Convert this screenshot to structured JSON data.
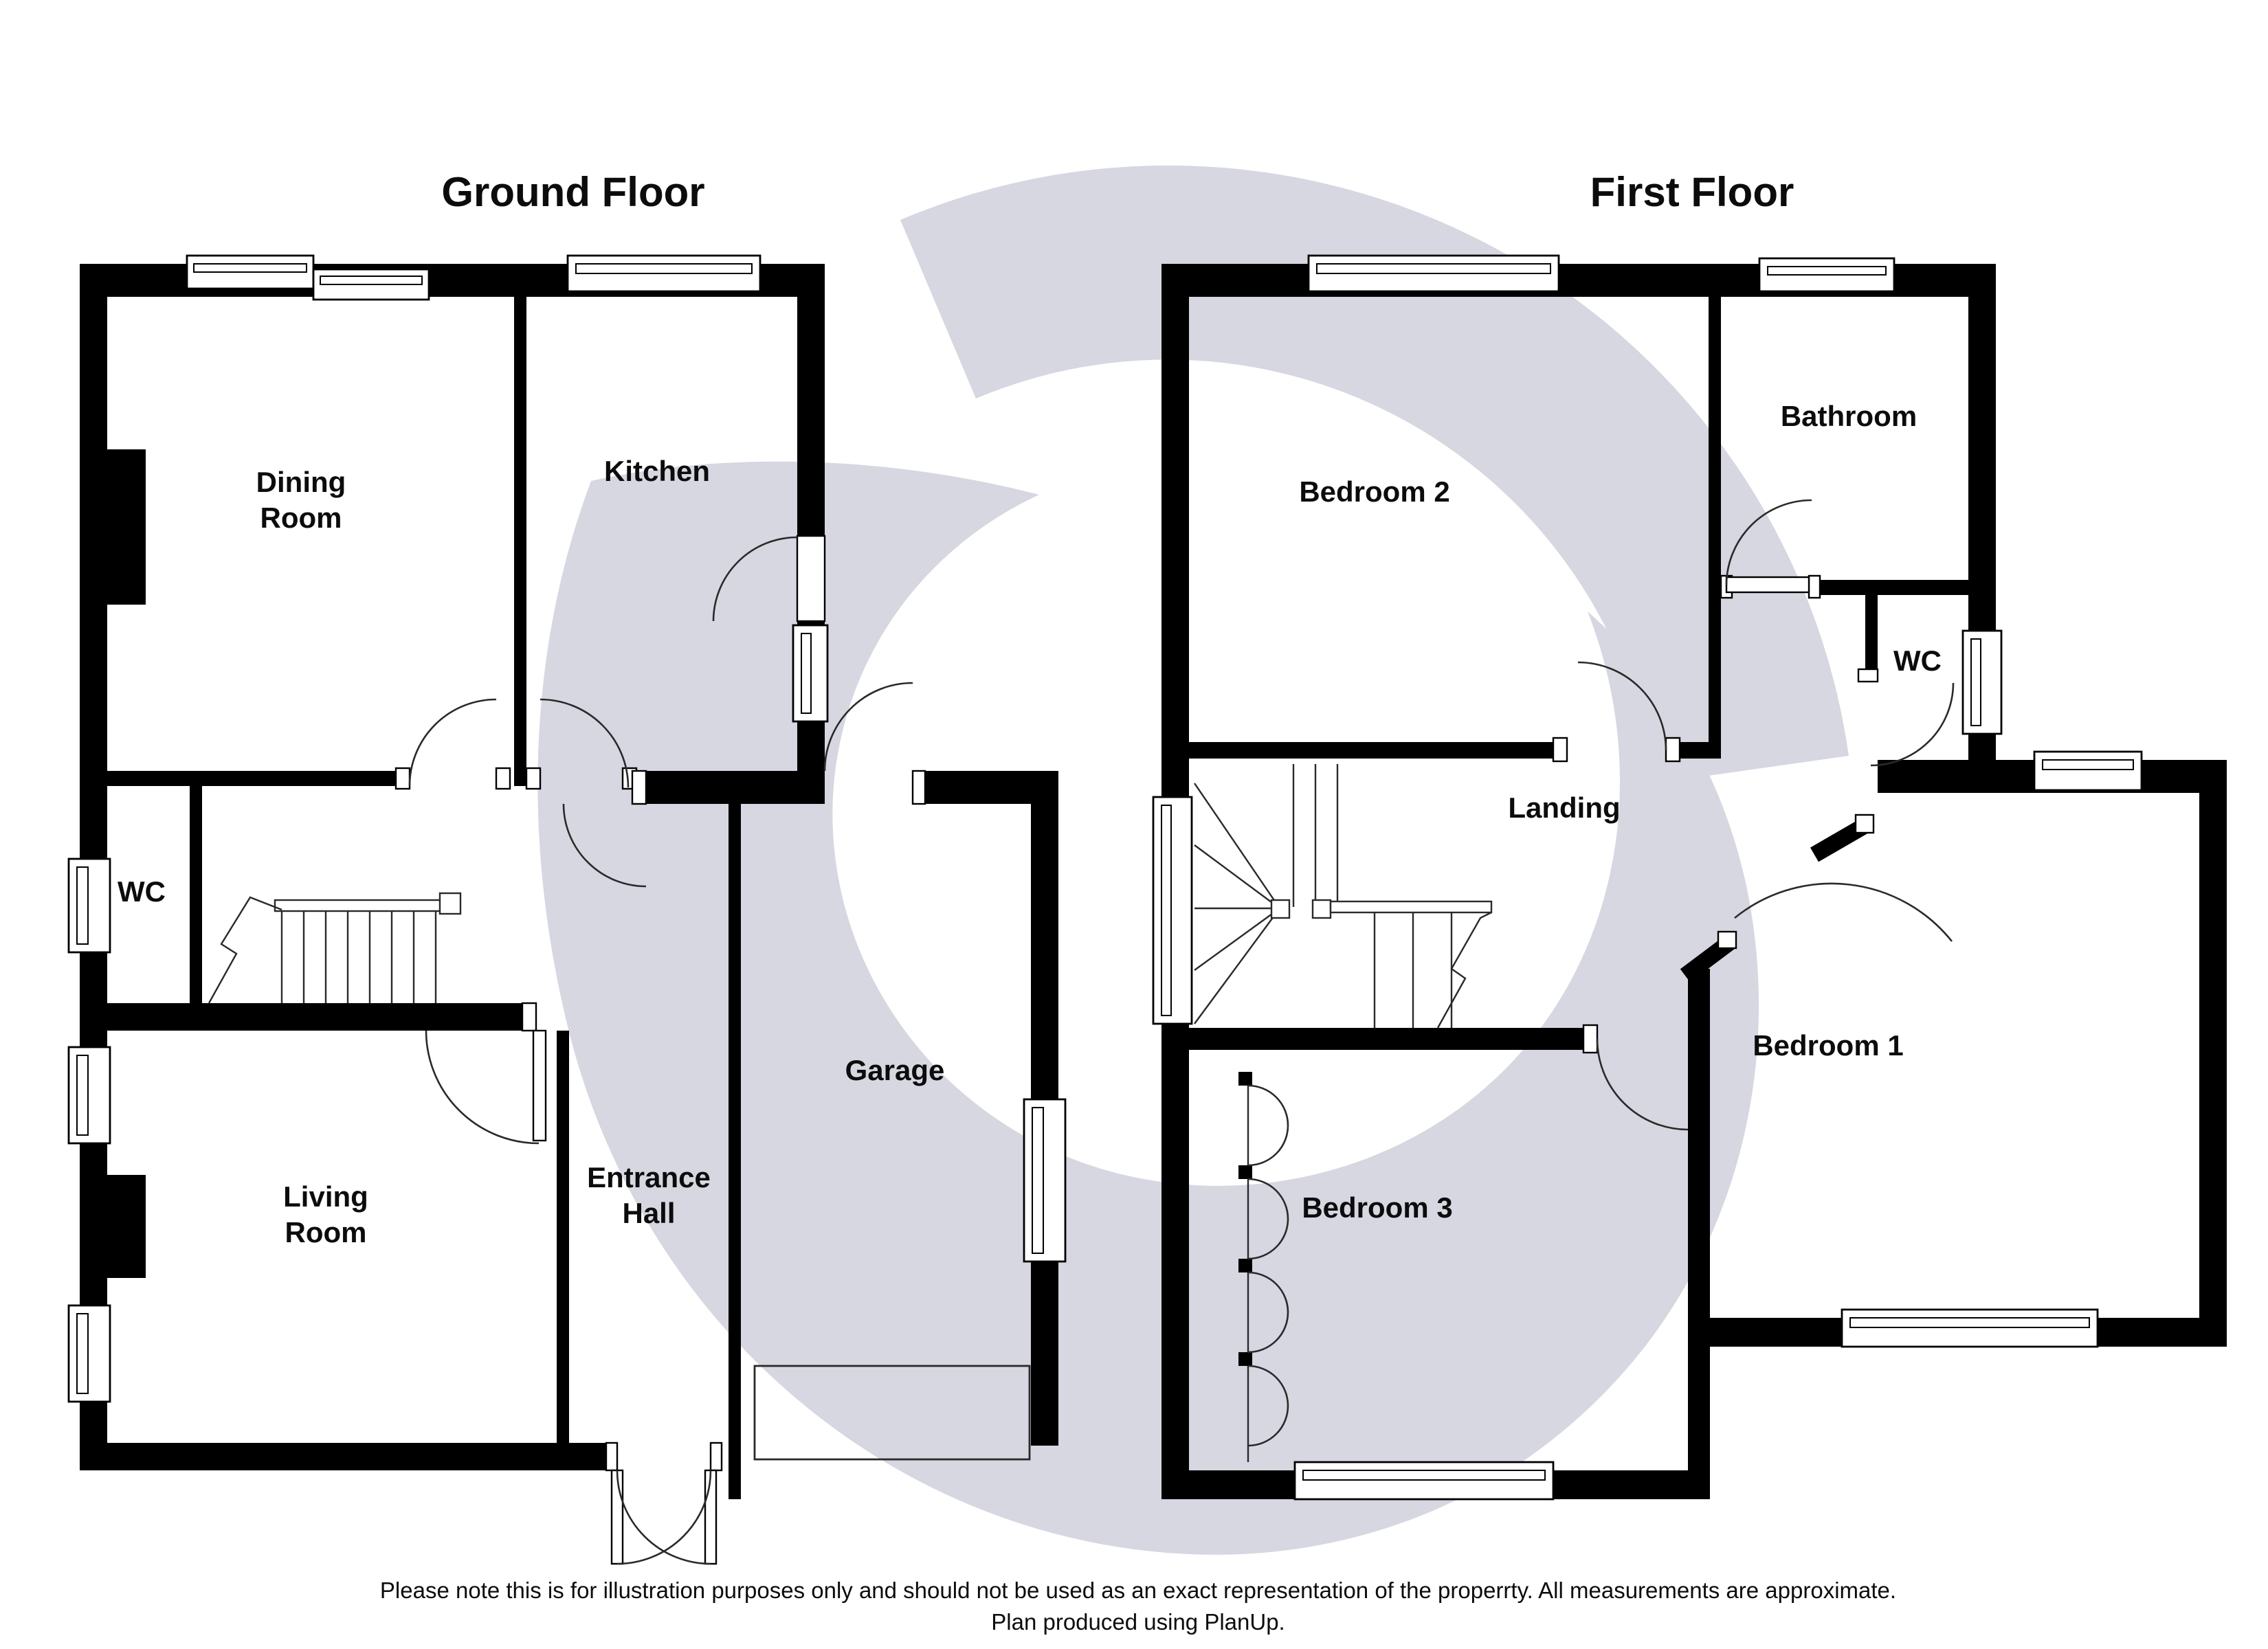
{
  "page": {
    "background": "#ffffff",
    "wall_color": "#000000",
    "watermark_color": "#d6d7e0"
  },
  "ground_floor": {
    "title": "Ground Floor",
    "labels": {
      "dining": {
        "line1": "Dining",
        "line2": "Room"
      },
      "kitchen": "Kitchen",
      "wc": "WC",
      "living": {
        "line1": "Living",
        "line2": "Room"
      },
      "entrance": {
        "line1": "Entrance",
        "line2": "Hall"
      },
      "garage": "Garage"
    }
  },
  "first_floor": {
    "title": "First Floor",
    "labels": {
      "bedroom2": "Bedroom 2",
      "bathroom": "Bathroom",
      "wc": "WC",
      "landing": "Landing",
      "bedroom1": "Bedroom 1",
      "bedroom3": "Bedroom 3"
    }
  },
  "footer": {
    "line1": "Please note this is for illustration purposes only and should not be used as an exact representation of the properrty. All measurements are approximate.",
    "line2": "Plan produced using PlanUp."
  }
}
